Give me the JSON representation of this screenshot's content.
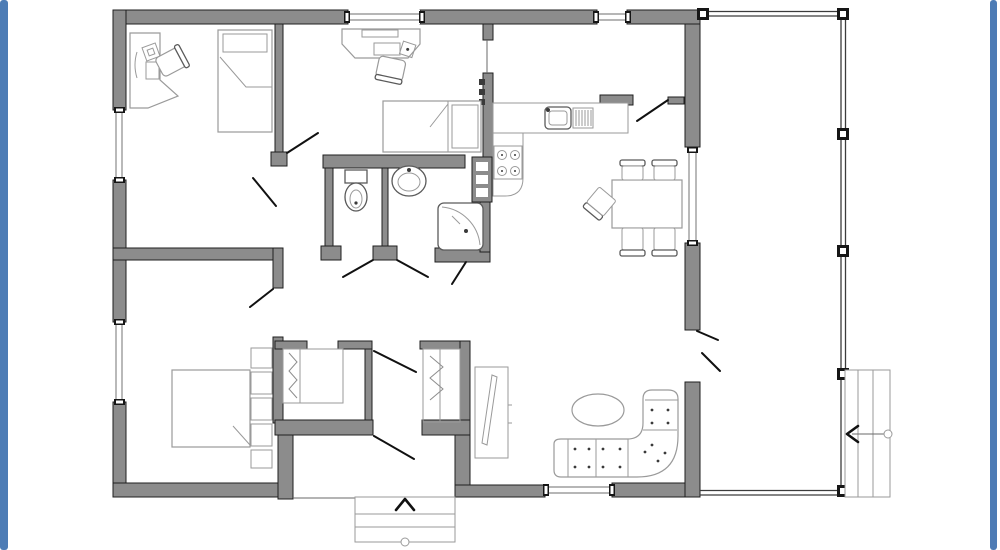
{
  "meta": {
    "kind": "architectural-floor-plan",
    "view": "top-down 2D plan of a single-storey house with side porch",
    "visible_text": "none"
  },
  "colors": {
    "page_bg": "#ffffff",
    "frame_accent": "#4d7cb5",
    "wall_fill": "#8c8c8c",
    "wall_outline": "#1f1f1f",
    "furniture_line": "#9a9a9a",
    "fixture_line": "#5a5a5a",
    "door_line": "#111111",
    "porch_line": "#3c3c3c"
  },
  "rooms": [
    {
      "name": "office-bedroom-top-left",
      "furniture": [
        "corner-desk",
        "desk-lamp",
        "paper",
        "office-chair",
        "single-bed-with-pillow"
      ]
    },
    {
      "name": "bedroom-top-middle",
      "furniture": [
        "desk",
        "keyboard",
        "office-chair",
        "single-bed-with-pillow"
      ]
    },
    {
      "name": "wc",
      "furniture": [
        "toilet"
      ]
    },
    {
      "name": "washroom",
      "furniture": [
        "washbasin",
        "shower-cabin"
      ]
    },
    {
      "name": "kitchen",
      "furniture": [
        "counter",
        "sink-with-drainer",
        "stove-4-burners",
        "appliance-column"
      ]
    },
    {
      "name": "dining-area",
      "furniture": [
        "dining-table",
        "chair",
        "chair",
        "chair",
        "chair",
        "chair"
      ]
    },
    {
      "name": "living-room",
      "furniture": [
        "corner-sofa",
        "oval-coffee-table"
      ]
    },
    {
      "name": "master-bedroom-bottom-left",
      "furniture": [
        "double-bed",
        "shelf-column"
      ]
    },
    {
      "name": "hallway",
      "furniture": [
        "closet-with-clothes-rail",
        "closet-with-clothes-rail",
        "mirror-cabinet"
      ]
    },
    {
      "name": "entry",
      "furniture": [
        "entry-steps",
        "entrance-direction-arrow"
      ]
    },
    {
      "name": "porch",
      "furniture": [
        "posts",
        "side-stairs",
        "stairs-direction-arrow"
      ]
    }
  ],
  "counts": {
    "windows": 6,
    "door_swings": 10,
    "porch_posts": 6,
    "entry_steps": 3,
    "side_stair_treads": 3
  }
}
